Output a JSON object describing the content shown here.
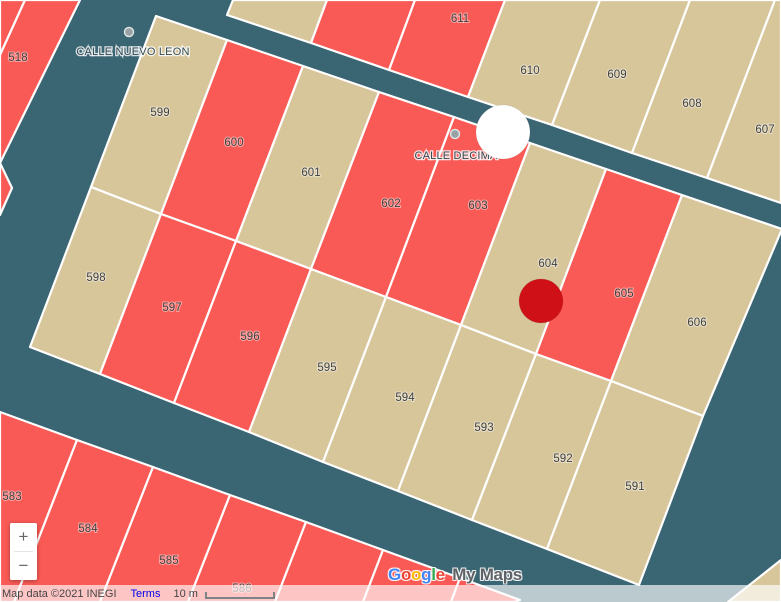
{
  "map": {
    "background": "#3a6572",
    "border_color": "#ffffff",
    "parcel_colors": {
      "red": "#fa5a55",
      "tan": "#d8c69b"
    },
    "label_color": "#3e4042",
    "street_dot_color": "#98a1a6"
  },
  "parcels": [
    {
      "id": "corner-nw-sliver",
      "color": "red",
      "points": [
        [
          0,
          0
        ],
        [
          25,
          0
        ],
        [
          0,
          55
        ]
      ]
    },
    {
      "id": "518",
      "label": "518",
      "lx": 18,
      "ly": 58,
      "color": "red",
      "points": [
        [
          25,
          0
        ],
        [
          80,
          0
        ],
        [
          0,
          163
        ],
        [
          0,
          55
        ]
      ]
    },
    {
      "id": "left-remnant",
      "color": "red",
      "points": [
        [
          0,
          163
        ],
        [
          12,
          188
        ],
        [
          0,
          215
        ]
      ]
    },
    {
      "id": "top-a",
      "color": "tan",
      "points": [
        [
          233,
          0
        ],
        [
          327,
          0
        ],
        [
          311,
          43
        ],
        [
          227,
          15
        ]
      ]
    },
    {
      "id": "top-b",
      "color": "red",
      "points": [
        [
          327,
          0
        ],
        [
          415,
          0
        ],
        [
          389,
          70
        ],
        [
          311,
          43
        ]
      ]
    },
    {
      "id": "611",
      "label": "611",
      "lx": 460,
      "ly": 19,
      "color": "red",
      "points": [
        [
          415,
          0
        ],
        [
          505,
          0
        ],
        [
          468,
          97
        ],
        [
          389,
          70
        ]
      ]
    },
    {
      "id": "610",
      "label": "610",
      "lx": 530,
      "ly": 71,
      "color": "tan",
      "points": [
        [
          505,
          0
        ],
        [
          600,
          0
        ],
        [
          552,
          125
        ],
        [
          468,
          97
        ]
      ]
    },
    {
      "id": "609",
      "label": "609",
      "lx": 617,
      "ly": 75,
      "color": "tan",
      "points": [
        [
          600,
          0
        ],
        [
          690,
          0
        ],
        [
          632,
          153
        ],
        [
          552,
          125
        ]
      ]
    },
    {
      "id": "608",
      "label": "608",
      "lx": 692,
      "ly": 104,
      "color": "tan",
      "points": [
        [
          690,
          0
        ],
        [
          775,
          0
        ],
        [
          707,
          178
        ],
        [
          632,
          153
        ]
      ]
    },
    {
      "id": "607",
      "label": "607",
      "lx": 765,
      "ly": 130,
      "color": "tan",
      "points": [
        [
          775,
          0
        ],
        [
          781,
          0
        ],
        [
          781,
          203
        ],
        [
          707,
          178
        ]
      ]
    },
    {
      "id": "599",
      "label": "599",
      "lx": 160,
      "ly": 113,
      "color": "tan",
      "points": [
        [
          156,
          16
        ],
        [
          227,
          40
        ],
        [
          161,
          214
        ],
        [
          91,
          187
        ]
      ]
    },
    {
      "id": "600",
      "label": "600",
      "lx": 234,
      "ly": 143,
      "color": "red",
      "points": [
        [
          227,
          40
        ],
        [
          303,
          66
        ],
        [
          236,
          241
        ],
        [
          161,
          214
        ]
      ]
    },
    {
      "id": "601",
      "label": "601",
      "lx": 311,
      "ly": 173,
      "color": "tan",
      "points": [
        [
          303,
          66
        ],
        [
          379,
          92
        ],
        [
          311,
          269
        ],
        [
          236,
          241
        ]
      ]
    },
    {
      "id": "602",
      "label": "602",
      "lx": 391,
      "ly": 204,
      "color": "red",
      "points": [
        [
          379,
          92
        ],
        [
          454,
          117
        ],
        [
          386,
          297
        ],
        [
          311,
          269
        ]
      ]
    },
    {
      "id": "603",
      "label": "603",
      "lx": 478,
      "ly": 206,
      "color": "red",
      "points": [
        [
          454,
          117
        ],
        [
          530,
          143
        ],
        [
          461,
          325
        ],
        [
          386,
          297
        ]
      ]
    },
    {
      "id": "604",
      "label": "604",
      "lx": 548,
      "ly": 264,
      "color": "tan",
      "points": [
        [
          530,
          143
        ],
        [
          606,
          169
        ],
        [
          536,
          354
        ],
        [
          461,
          325
        ]
      ]
    },
    {
      "id": "605",
      "label": "605",
      "lx": 624,
      "ly": 294,
      "color": "red",
      "points": [
        [
          606,
          169
        ],
        [
          682,
          195
        ],
        [
          611,
          381
        ],
        [
          536,
          354
        ]
      ]
    },
    {
      "id": "606",
      "label": "606",
      "lx": 697,
      "ly": 323,
      "color": "tan",
      "points": [
        [
          682,
          195
        ],
        [
          782,
          229
        ],
        [
          703,
          416
        ],
        [
          611,
          381
        ]
      ]
    },
    {
      "id": "598",
      "label": "598",
      "lx": 96,
      "ly": 278,
      "color": "tan",
      "points": [
        [
          91,
          187
        ],
        [
          161,
          214
        ],
        [
          100,
          374
        ],
        [
          30,
          347
        ]
      ]
    },
    {
      "id": "597",
      "label": "597",
      "lx": 172,
      "ly": 308,
      "color": "red",
      "points": [
        [
          161,
          214
        ],
        [
          236,
          241
        ],
        [
          174,
          403
        ],
        [
          100,
          374
        ]
      ]
    },
    {
      "id": "596",
      "label": "596",
      "lx": 250,
      "ly": 337,
      "color": "red",
      "points": [
        [
          236,
          241
        ],
        [
          311,
          269
        ],
        [
          249,
          432
        ],
        [
          174,
          403
        ]
      ]
    },
    {
      "id": "595",
      "label": "595",
      "lx": 327,
      "ly": 368,
      "color": "tan",
      "points": [
        [
          311,
          269
        ],
        [
          386,
          297
        ],
        [
          323,
          462
        ],
        [
          249,
          432
        ]
      ]
    },
    {
      "id": "594",
      "label": "594",
      "lx": 405,
      "ly": 398,
      "color": "tan",
      "points": [
        [
          386,
          297
        ],
        [
          461,
          325
        ],
        [
          398,
          491
        ],
        [
          323,
          462
        ]
      ]
    },
    {
      "id": "593",
      "label": "593",
      "lx": 484,
      "ly": 428,
      "color": "tan",
      "points": [
        [
          461,
          325
        ],
        [
          536,
          354
        ],
        [
          472,
          520
        ],
        [
          398,
          491
        ]
      ]
    },
    {
      "id": "592",
      "label": "592",
      "lx": 563,
      "ly": 459,
      "color": "tan",
      "points": [
        [
          536,
          354
        ],
        [
          611,
          381
        ],
        [
          547,
          549
        ],
        [
          472,
          520
        ]
      ]
    },
    {
      "id": "591",
      "label": "591",
      "lx": 635,
      "ly": 487,
      "color": "tan",
      "points": [
        [
          611,
          381
        ],
        [
          703,
          416
        ],
        [
          639,
          585
        ],
        [
          547,
          549
        ]
      ]
    },
    {
      "id": "583",
      "label": "583",
      "lx": 12,
      "ly": 497,
      "color": "red",
      "points": [
        [
          0,
          412
        ],
        [
          77,
          440
        ],
        [
          14,
          602
        ],
        [
          0,
          602
        ]
      ]
    },
    {
      "id": "584",
      "label": "584",
      "lx": 88,
      "ly": 529,
      "color": "red",
      "points": [
        [
          77,
          440
        ],
        [
          153,
          467
        ],
        [
          100,
          602
        ],
        [
          14,
          602
        ]
      ]
    },
    {
      "id": "585",
      "label": "585",
      "lx": 169,
      "ly": 561,
      "color": "red",
      "points": [
        [
          153,
          467
        ],
        [
          230,
          495
        ],
        [
          188,
          602
        ],
        [
          100,
          602
        ]
      ]
    },
    {
      "id": "586",
      "label": "586",
      "lx": 242,
      "ly": 589,
      "color": "red",
      "points": [
        [
          230,
          495
        ],
        [
          306,
          522
        ],
        [
          275,
          602
        ],
        [
          188,
          602
        ]
      ]
    },
    {
      "id": "587",
      "color": "red",
      "points": [
        [
          306,
          522
        ],
        [
          383,
          550
        ],
        [
          363,
          602
        ],
        [
          275,
          602
        ]
      ]
    },
    {
      "id": "588",
      "color": "red",
      "points": [
        [
          383,
          550
        ],
        [
          460,
          578
        ],
        [
          451,
          602
        ],
        [
          363,
          602
        ]
      ]
    },
    {
      "id": "589",
      "color": "red",
      "points": [
        [
          460,
          578
        ],
        [
          520,
          600
        ],
        [
          514,
          602
        ],
        [
          451,
          602
        ]
      ]
    },
    {
      "id": "corner-se",
      "color": "tan",
      "points": [
        [
          728,
          602
        ],
        [
          781,
          560
        ],
        [
          781,
          602
        ]
      ]
    }
  ],
  "streets": [
    {
      "name": "CALLE NUEVO LEON",
      "x": 133,
      "y": 52,
      "dot_x": 129,
      "dot_y": 32
    },
    {
      "name": "CALLE DECIMA",
      "x": 456,
      "y": 156,
      "dot_x": 455,
      "dot_y": 134
    }
  ],
  "markers": [
    {
      "name": "white-circle-marker",
      "x": 503,
      "y": 132,
      "r": 27,
      "color": "#ffffff"
    },
    {
      "name": "red-circle-marker",
      "x": 541,
      "y": 301,
      "r": 22,
      "color": "#cf1016"
    }
  ],
  "zoom_control": {
    "zoom_in": "+",
    "zoom_out": "−"
  },
  "logo": {
    "google_letters": [
      {
        "ch": "G",
        "color": "#4285F4"
      },
      {
        "ch": "o",
        "color": "#EA4335"
      },
      {
        "ch": "o",
        "color": "#FBBC05"
      },
      {
        "ch": "g",
        "color": "#4285F4"
      },
      {
        "ch": "l",
        "color": "#34A853"
      },
      {
        "ch": "e",
        "color": "#EA4335"
      }
    ],
    "suffix": "My Maps",
    "suffix_color": "#5f6368"
  },
  "attribution": {
    "map_data": "Map data ©2021 INEGI",
    "terms": "Terms",
    "scale_label": "10 m"
  }
}
